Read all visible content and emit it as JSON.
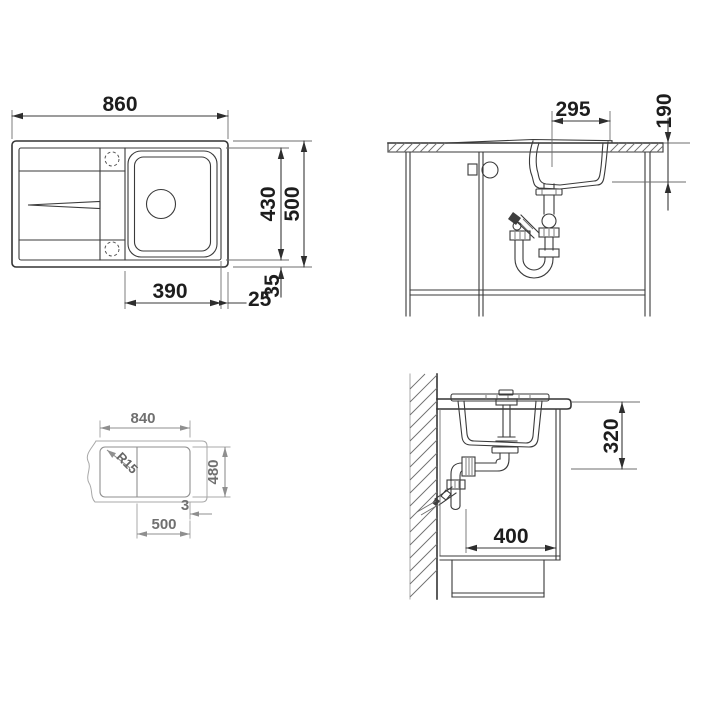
{
  "meta": {
    "title": "Kitchen sink installation technical drawing",
    "type": "technical-drawing"
  },
  "colors": {
    "background": "#ffffff",
    "line_dark": "#3a3a3a",
    "line_light": "#a8a8a8",
    "text_dark": "#1d1d1d",
    "text_light": "#707070"
  },
  "plan": {
    "overall_width": "860",
    "basin_length": "430",
    "overall_depth": "500",
    "bowl_width": "390",
    "right_margin": "25",
    "bottom_margin": "35"
  },
  "front": {
    "bowl_inner_width": "295",
    "bowl_depth": "190"
  },
  "cutout": {
    "width": "840",
    "depth": "480",
    "corner_radius": "R15",
    "bowl_zone": "500",
    "lip": "3"
  },
  "side": {
    "under_top_clearance": "320",
    "drain_wall_offset": "400"
  }
}
